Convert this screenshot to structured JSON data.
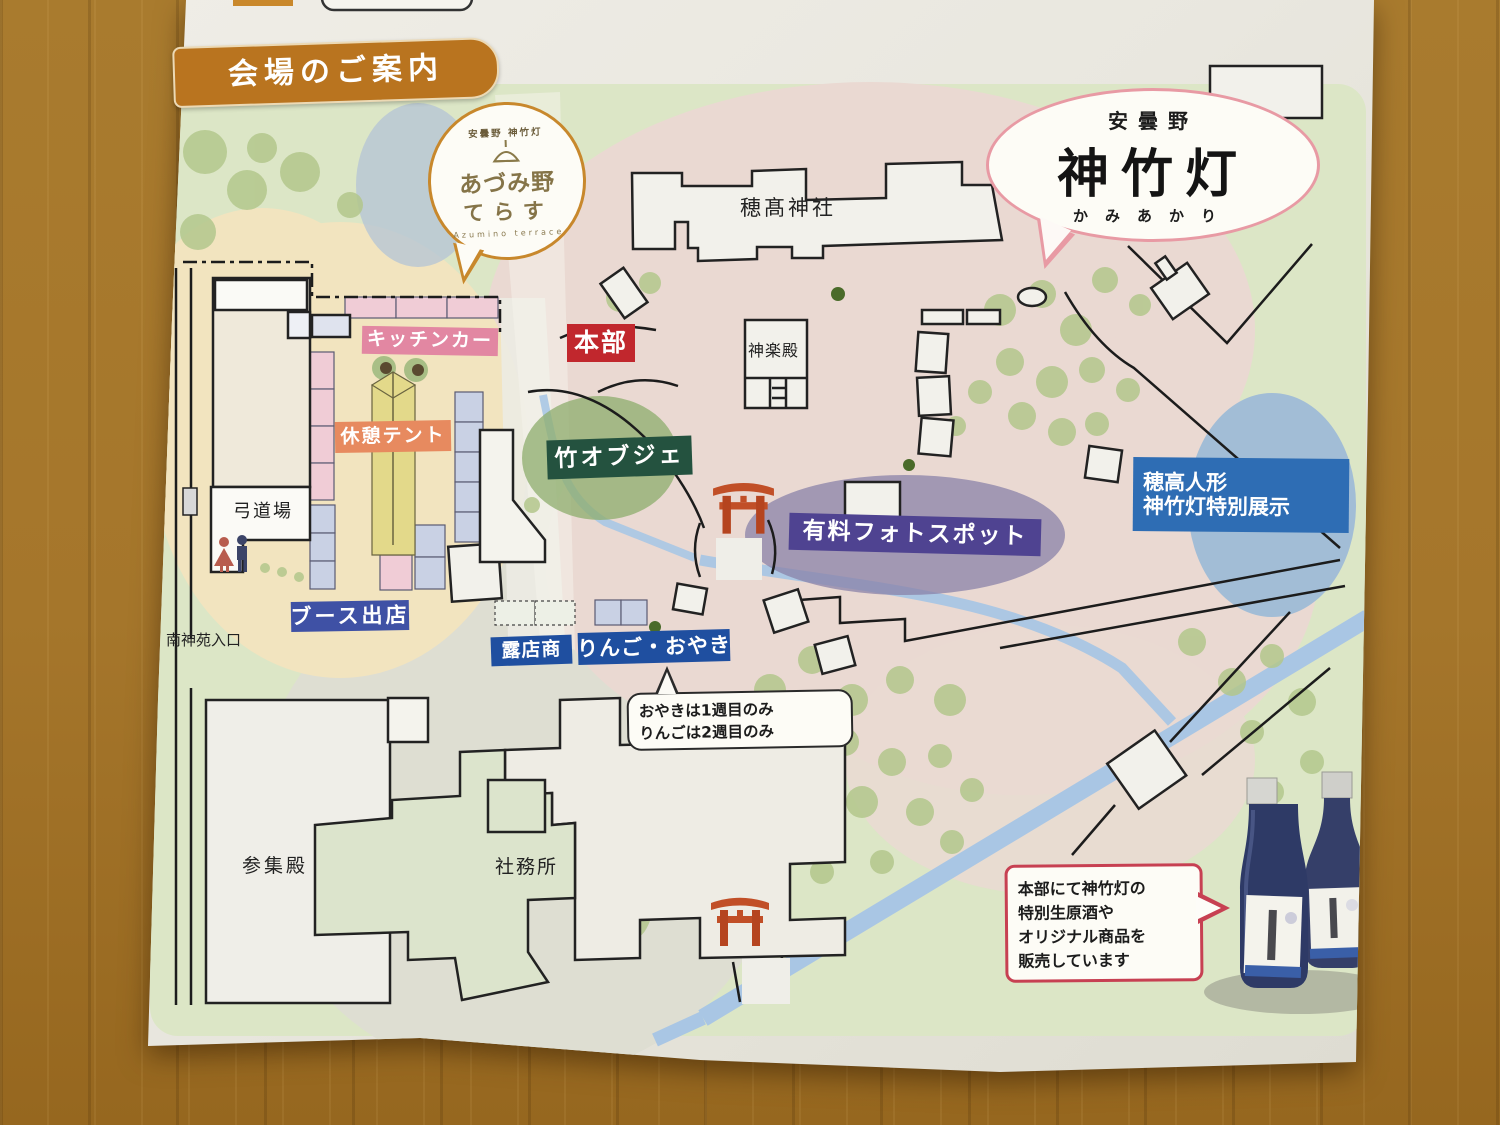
{
  "header": {
    "title_badge": "会場のご案内"
  },
  "logos": {
    "terrace": {
      "arc_text": "安曇野 神竹灯",
      "main_line1": "あづみ野",
      "main_line2": "てらす",
      "subtitle": "Azumino terrace"
    },
    "kamiakari": {
      "region": "安曇野",
      "main": "神竹灯",
      "reading": "かみあかり"
    }
  },
  "map_labels": {
    "shrine": "穂髙神社",
    "kagura_hall": "神楽殿",
    "kitchen_car": "キッチンカー",
    "headquarters": "本部",
    "rest_tent": "休憩テント",
    "bamboo_object": "竹オブジェ",
    "paid_photo_spot": "有料フォトスポット",
    "hotaka_doll_line1": "穂高人形",
    "hotaka_doll_line2": "神竹灯特別展示",
    "kyudojo": "弓道場",
    "booth_stalls": "ブース出店",
    "street_vendors": "露店商",
    "apple_oyaki": "りんご・おやき",
    "south_entrance": "南神苑入口",
    "sanshuden": "参集殿",
    "shrine_office": "社務所"
  },
  "notes": {
    "oyaki_line1": "おやきは1週目のみ",
    "oyaki_line2": "りんごは2週目のみ",
    "sales_line1": "本部にて神竹灯の",
    "sales_line2": "特別生原酒や",
    "sales_line3": "オリジナル商品を",
    "sales_line4": "販売しています"
  },
  "colors": {
    "badge_orange": "#b9741f",
    "headquarters_red": "#c1272d",
    "kitchen_pink": "#e287a2",
    "rest_tent_orange": "#e78a5f",
    "bamboo_green": "#24523f",
    "photo_purple": "#4f4391",
    "doll_blue": "#2e6db4",
    "booth_blue": "#3f51a5",
    "vendor_blue": "#1f4fa0",
    "torii_vermilion": "#c14f27",
    "pond_blue": "#a2bdd6",
    "stream_blue": "#a9c6e4",
    "wood_table": "#a5762b"
  }
}
